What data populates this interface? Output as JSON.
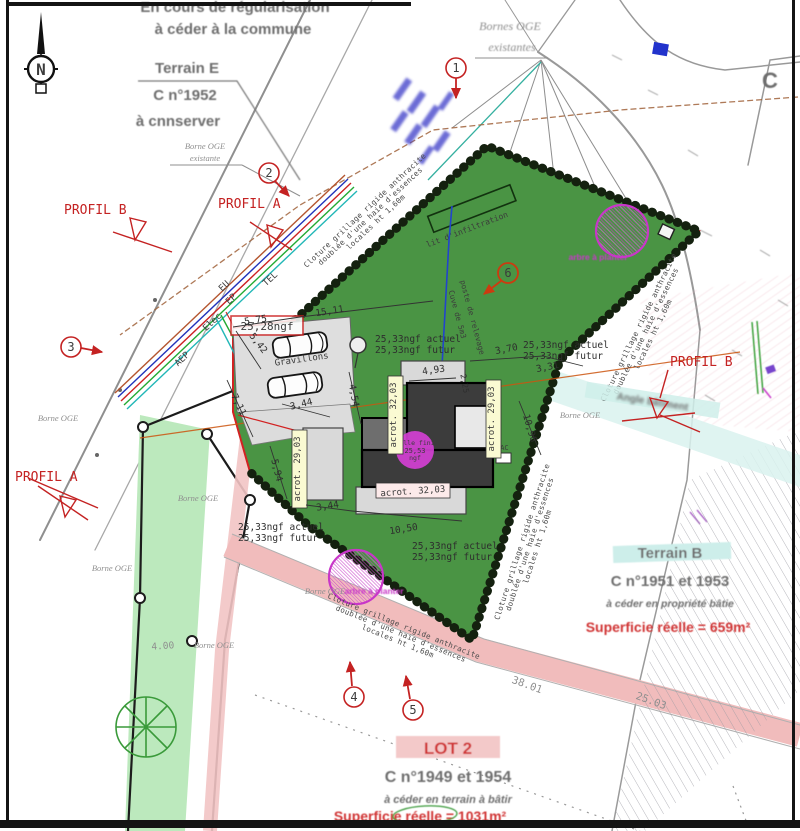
{
  "compass": {
    "letter": "N"
  },
  "top_area": {
    "regularisation_1": "En cours de régularisation",
    "regularisation_2": "à céder à la commune",
    "terrain_e_title": "Terrain E",
    "terrain_e_parcel": "C n°1952",
    "terrain_e_note": "à cnnserver",
    "zone_letter": "C"
  },
  "bornes": {
    "borne_oge": "Borne OGE",
    "existante": "existante",
    "bornes_oge": "Bornes OGE",
    "existantes": "existantes"
  },
  "profils": {
    "a": "PROFIL A",
    "b": "PROFIL B"
  },
  "markers": [
    "1",
    "2",
    "3",
    "4",
    "5",
    "6"
  ],
  "utilities": [
    "EU",
    "EP",
    "TEL",
    "Elec",
    "AEP"
  ],
  "levels": {
    "entry_level": "25,28ngf",
    "actuel": "25,33ngf actuel",
    "futur": "25,33ngf futur"
  },
  "building": {
    "acrot_32": "acrot. 32,03",
    "acrot_29": "acrot. 29,03",
    "dalle_line1": "dalle fini",
    "dalle_line2": "25,53",
    "dalle_line3": "ngf",
    "pac": "PAC"
  },
  "site": {
    "gravillons": "Gravillons",
    "infiltration": "lit d'infiltration",
    "cuve": "Cuve de 5m3",
    "poste_relevage": "poste de relevage",
    "arbre": "arbre à planter",
    "angle_batiment": "Angle bâtiment",
    "cloture_1": "Cloture grillage rigide anthracite",
    "cloture_2": "doublée d'une haie d'essences",
    "cloture_3": "locales ht 1,60m"
  },
  "dims": [
    "5,75",
    "15,11",
    "5,42",
    "7,11",
    "3,44",
    "5,94",
    "4,54",
    "4,93",
    "2,25",
    "3,70",
    "3,31",
    "10,96",
    "3,44",
    "10,50",
    "4.00",
    "38.01",
    "25.03"
  ],
  "parcels": {
    "terrain_b": {
      "name": "Terrain B",
      "cadastre": "C n°1951 et 1953",
      "note": "à céder en propriété bâtie",
      "area": "Superficie réelle = 659m²"
    },
    "lot_2": {
      "name": "LOT 2",
      "cadastre": "C n°1949 et 1954",
      "note": "à céder en terrain à bâtir",
      "area": "Superficie réelle = 1031m²"
    }
  },
  "colors": {
    "parcel_green": "#4a9444",
    "hedge_black": "#14210f",
    "boundary_red": "#d22222",
    "tree_magenta": "#c837c8",
    "road_pink": "#f1bcbc",
    "path_green": "#bce9bd",
    "highlight_cyan": "#cdeeea",
    "annotation_red": "#c42222",
    "cad_gray": "#3c3c3c"
  }
}
